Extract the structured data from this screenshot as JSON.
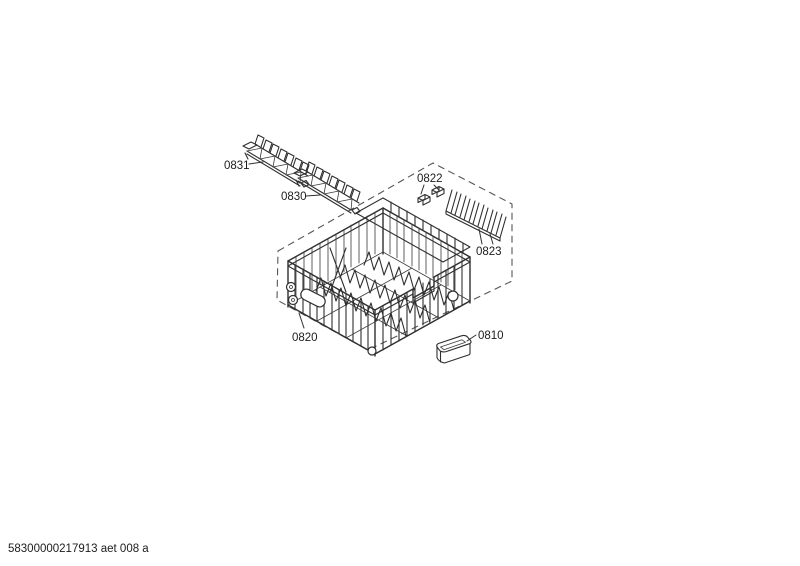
{
  "colors": {
    "background": "#ffffff",
    "line": "#2f2f2f",
    "dashed_outline": "#555555",
    "label_text": "#1c1c1c"
  },
  "footer": {
    "code": "58300000217913 aet 008 a"
  },
  "parts": {
    "insert_upper": {
      "label": "0831"
    },
    "insert_lower": {
      "label": "0830"
    },
    "clips": {
      "label": "0822"
    },
    "tine_rack": {
      "label": "0823"
    },
    "basket_assembly": {
      "label": "0820"
    },
    "tray": {
      "label": "0810"
    }
  }
}
